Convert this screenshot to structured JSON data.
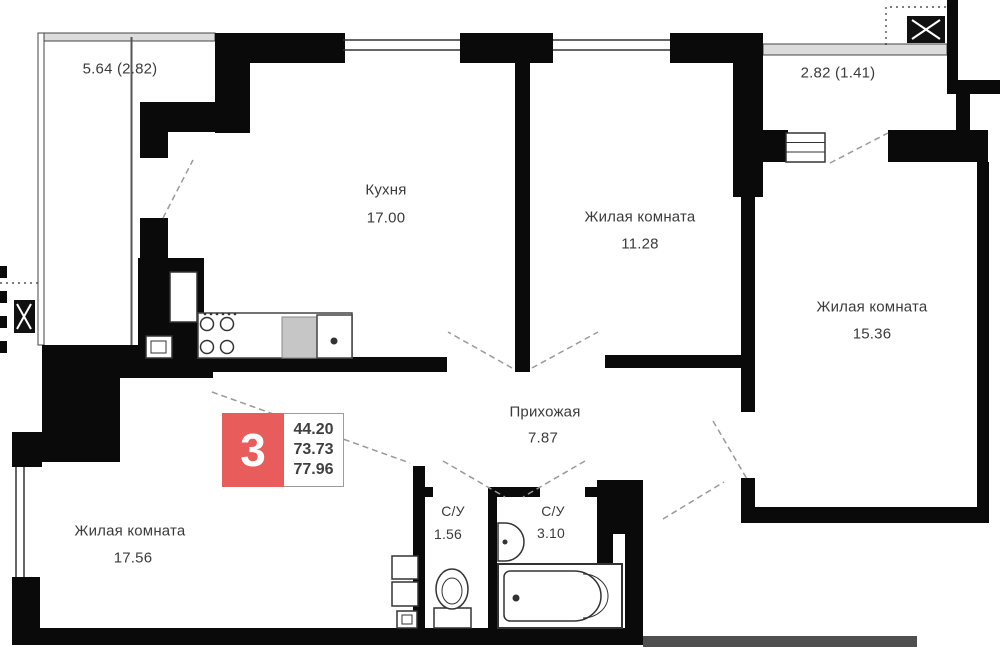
{
  "plan": {
    "type": "apartment-floor-plan",
    "dimensions": {
      "balcony_left": "5.64 (2.82)",
      "balcony_right": "2.82 (1.41)"
    },
    "rooms": {
      "kitchen": {
        "label": "Кухня",
        "area": "17.00"
      },
      "living_top": {
        "label": "Жилая комната",
        "area": "11.28"
      },
      "living_right": {
        "label": "Жилая комната",
        "area": "15.36"
      },
      "living_left": {
        "label": "Жилая комната",
        "area": "17.56"
      },
      "hallway": {
        "label": "Прихожая",
        "area": "7.87"
      },
      "wc_small": {
        "label": "С/У",
        "area": "1.56"
      },
      "wc_large": {
        "label": "С/У",
        "area": "3.10"
      }
    },
    "badge": {
      "rooms_count": "3",
      "areas": [
        "44.20",
        "73.73",
        "77.96"
      ]
    },
    "colors": {
      "wall": "#0a0a0a",
      "badge_red": "#e85c5c",
      "railing": "#dcdcdc",
      "text": "#3b3b3b"
    }
  }
}
